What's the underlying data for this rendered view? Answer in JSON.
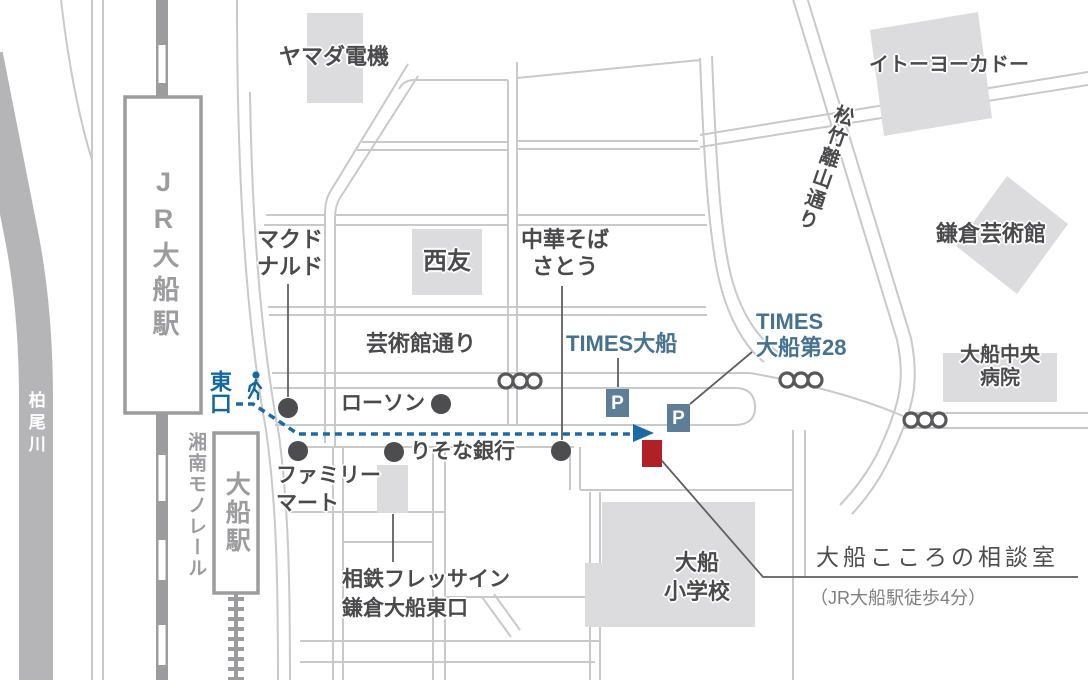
{
  "destination": {
    "name": "大船こころの相談室",
    "walk_note": "（JR大船駅徒歩4分）"
  },
  "stations": {
    "jr_station": "JR大船駅",
    "east_exit": "東口",
    "monorail_line": "湘南モノレール",
    "monorail_station": "大船駅"
  },
  "river": {
    "name": "柏尾川"
  },
  "streets": {
    "geijutsukan_dori": "芸術館通り",
    "shochiku_rizan_dori": "松竹離山通り"
  },
  "places": {
    "yamada_denki": "ヤマダ電機",
    "ito_yokado": "イトーヨーカドー",
    "kamakura_arts_hall": "鎌倉芸術館",
    "ofuna_chuo_hospital": "大船中央\n病院",
    "seiyu": "西友",
    "mcdonalds": "マクド\nナルド",
    "chuka_soba_sato": "中華そば\nさとう",
    "lawson": "ローソン",
    "risona_bank": "りそな銀行",
    "family_mart": "ファミリー\nマート",
    "sotetsu_fresa_inn": "相鉄フレッサイン\n鎌倉大船東口",
    "ofuna_elementary": "大船\n小学校"
  },
  "parking": {
    "times_ofuna": "TIMES大船",
    "times_ofuna_28": "TIMES\n大船第28",
    "p_mark": "P"
  },
  "colors": {
    "route_blue": "#1c6aa3",
    "accent_red": "#b02026",
    "parking_steel": "#5d7e96",
    "station_gray": "#9c9c9e",
    "road_gray": "#c9c9cb",
    "building_gray": "#dcdcde",
    "river_gray": "#b5b5b7",
    "text_dark": "#4a4a4c"
  }
}
